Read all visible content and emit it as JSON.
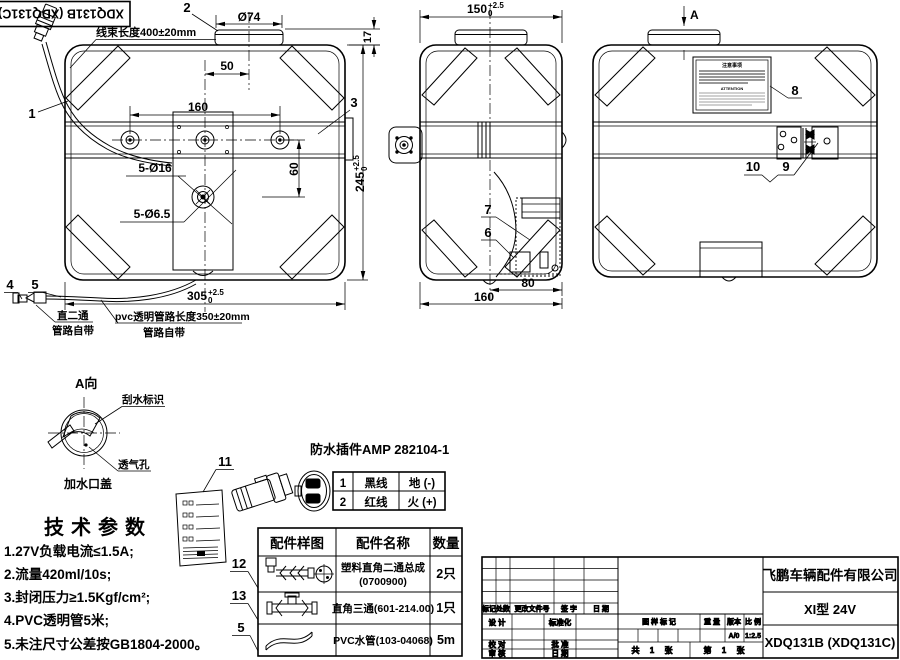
{
  "drawing": {
    "corner_code": "XDQ131B (XDQ131C)",
    "front_view": {
      "callout_1": "1",
      "callout_2": "2",
      "callout_3": "3",
      "callout_4": "4",
      "callout_5": "5",
      "harness_note": "线束长度400±20mm",
      "dim_cap_dia": "Ø74",
      "dim_cap_offset": "50",
      "dim_hole_span": "160",
      "dim_hole_drop": "60",
      "dim_holes_large": "5-Ø16",
      "dim_holes_small": "5-Ø6.5",
      "dim_width": "305",
      "dim_width_tol_up": "+2.5",
      "dim_width_tol_dn": "0",
      "dim_height": "245",
      "dim_height_tol_up": "+2.5",
      "dim_height_tol_dn": "0",
      "dim_cap_height": "17",
      "elbow_note_line1": "直二通",
      "elbow_note_line2": "管路自带",
      "pvc_note_line1": "pvc透明管路长度350±20mm",
      "pvc_note_line2": "管路自带"
    },
    "side_view": {
      "dim_depth_top": "150",
      "dim_depth_tol_up": "+2.5",
      "dim_depth_tol_dn": "0",
      "callout_6": "6",
      "callout_7": "7",
      "dim_pump": "80",
      "dim_depth_bottom": "160"
    },
    "rear_view": {
      "view_arrow_label": "A",
      "callout_8": "8",
      "callout_9": "9",
      "callout_10": "10",
      "label_title": "注意事项",
      "label_attention": "ATTENTION"
    },
    "view_a": {
      "title": "A向",
      "wiper_label": "刮水标识",
      "vent_label": "透气孔",
      "cap_label": "加水口盖"
    }
  },
  "tech_params": {
    "title": "技术参数",
    "items": [
      "1.27V负载电流≤1.5A;",
      "2.流量420ml/10s;",
      "3.封闭压力≥1.5Kgf/cm²;",
      "4.PVC透明管5米;",
      "5.未注尺寸公差按GB1804-2000。"
    ]
  },
  "connector": {
    "callout_11": "11",
    "title": "防水插件AMP 282104-1",
    "pin_1": "1",
    "pin_2": "2",
    "table": [
      {
        "no": "1",
        "wire": "黑线",
        "polarity": "地 (-)"
      },
      {
        "no": "2",
        "wire": "红线",
        "polarity": "火 (+)"
      }
    ]
  },
  "parts_table": {
    "callout_12": "12",
    "callout_13": "13",
    "callout_5": "5",
    "col_sample": "配件样图",
    "col_name": "配件名称",
    "col_qty": "数量",
    "rows": [
      {
        "name_top": "塑料直角二通总成",
        "name_bottom": "(0700900)",
        "qty": "2只"
      },
      {
        "name": "直角三通(601-214.00)",
        "qty": "1只"
      },
      {
        "name": "PVC水管(103-04068)",
        "qty": "5m"
      }
    ]
  },
  "title_block": {
    "company": "飞鹏车辆配件有限公司",
    "model": "XI型 24V",
    "drawing_no": "XDQ131B (XDQ131C)",
    "rev_mark": "标记",
    "rev_count": "处数",
    "rev_doc": "更改文件号",
    "rev_sign": "签 字",
    "rev_date": "日 期",
    "role_design": "设 计",
    "role_standard": "标准化",
    "role_check": "校 对",
    "role_approve": "批 准",
    "role_review": "审 核",
    "role_date": "日 期",
    "stamp_mark": "图 样 标 记",
    "stamp_weight": "重 量",
    "stamp_version": "版本",
    "stamp_scale": "比 例",
    "version_value": "A/0",
    "scale_value": "1:2.5",
    "sheet_total": "共 1 张",
    "sheet_page": "第 1 张"
  }
}
